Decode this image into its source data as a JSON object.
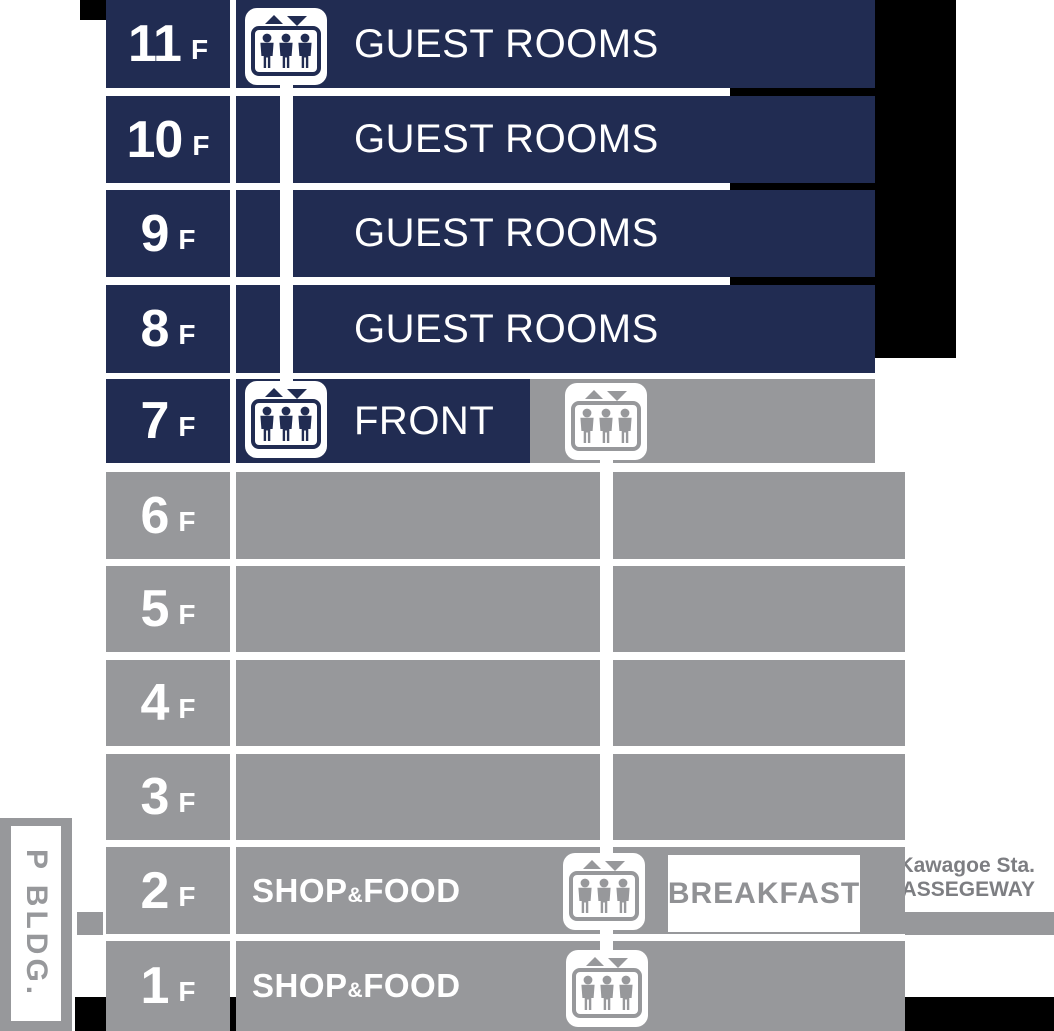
{
  "title": "Hotel floor guide",
  "colors": {
    "navy": "#212c52",
    "gray": "#97989b",
    "black": "#000000",
    "white": "#ffffff",
    "breakfast_text": "#909194",
    "station_text": "#7d7e82"
  },
  "icons": {
    "elevator": "elevator-people-icon"
  },
  "building": {
    "floors": [
      {
        "number": "11",
        "suffix": "F",
        "label": "GUEST ROOMS"
      },
      {
        "number": "10",
        "suffix": "F",
        "label": "GUEST ROOMS"
      },
      {
        "number": "9",
        "suffix": "F",
        "label": "GUEST ROOMS"
      },
      {
        "number": "8",
        "suffix": "F",
        "label": "GUEST ROOMS"
      },
      {
        "number": "7",
        "suffix": "F",
        "label": "FRONT"
      },
      {
        "number": "6",
        "suffix": "F",
        "label": ""
      },
      {
        "number": "5",
        "suffix": "F",
        "label": ""
      },
      {
        "number": "4",
        "suffix": "F",
        "label": ""
      },
      {
        "number": "3",
        "suffix": "F",
        "label": ""
      },
      {
        "number": "2",
        "suffix": "F",
        "label_pre": "SHOP",
        "label_amp": "&",
        "label_post": "FOOD"
      },
      {
        "number": "1",
        "suffix": "F",
        "label_pre": "SHOP",
        "label_amp": "&",
        "label_post": "FOOD"
      }
    ]
  },
  "breakfast": {
    "label": "BREAKFAST"
  },
  "station": {
    "line1": "Kawagoe Sta.",
    "line2": "PASSEGEWAY"
  },
  "parking": {
    "label": "P BLDG."
  }
}
